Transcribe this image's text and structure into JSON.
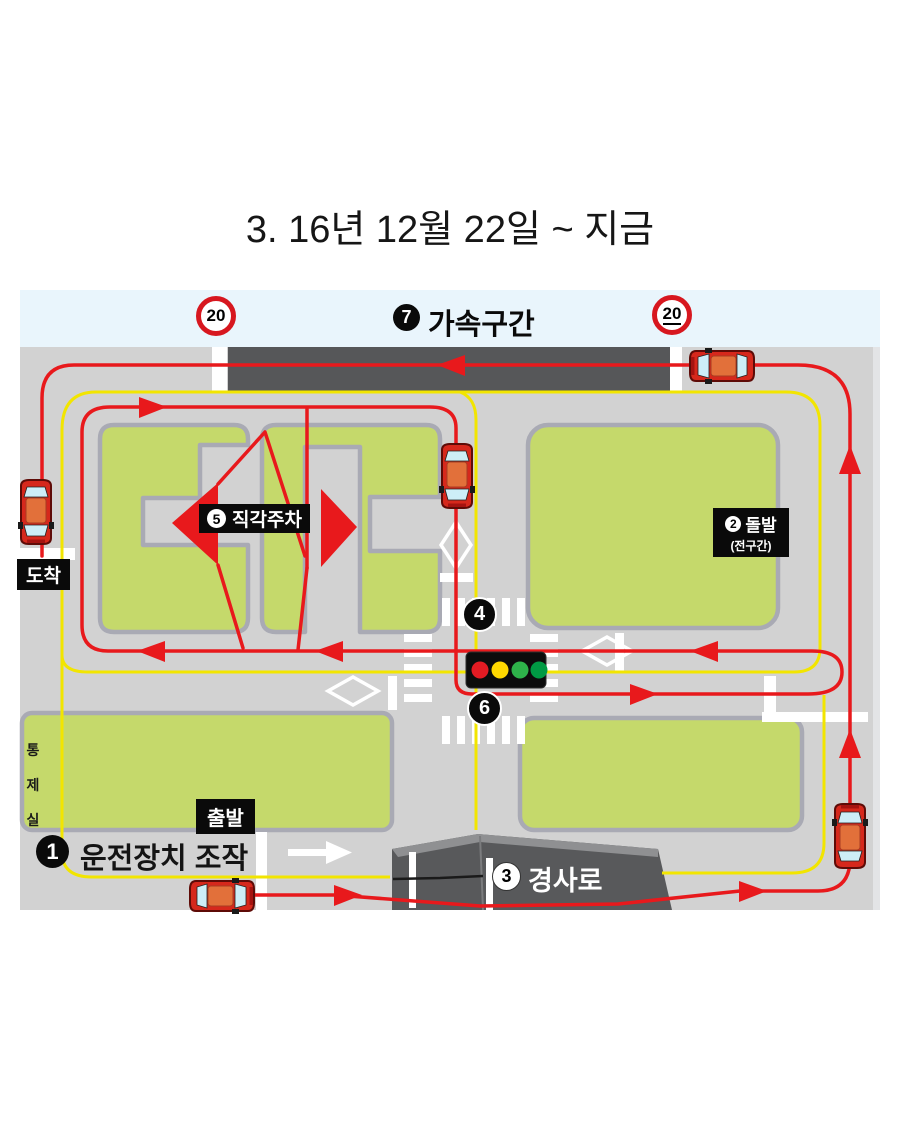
{
  "labels": {
    "title": "3. 16년 12월 22일 ~ 지금",
    "start": "출발",
    "finish": "도착",
    "control_room": "통제실"
  },
  "signs": {
    "speed_limit_left": "20",
    "speed_limit_right": "20"
  },
  "checkpoints": {
    "cp1": {
      "num": "1",
      "label": "운전장치 조작"
    },
    "cp2": {
      "num": "2",
      "label": "돌발",
      "sub": "(전구간)"
    },
    "cp3": {
      "num": "3",
      "label": "경사로"
    },
    "cp4": {
      "num": "4"
    },
    "cp5": {
      "num": "5",
      "label": "직각주차"
    },
    "cp6": {
      "num": "6"
    },
    "cp7": {
      "num": "7",
      "label": "가속구간"
    }
  },
  "colors": {
    "route_red": "#e8191c",
    "guide_yellow": "#f2e500",
    "grass_green": "#c5d96b",
    "road_gray": "#d2d2d2",
    "dark_road": "#565759",
    "sky": "#e9f5fc",
    "sign_ring_red": "#d7171f"
  },
  "traffic_light": {
    "lights": [
      "red",
      "yellow",
      "green",
      "green"
    ]
  }
}
